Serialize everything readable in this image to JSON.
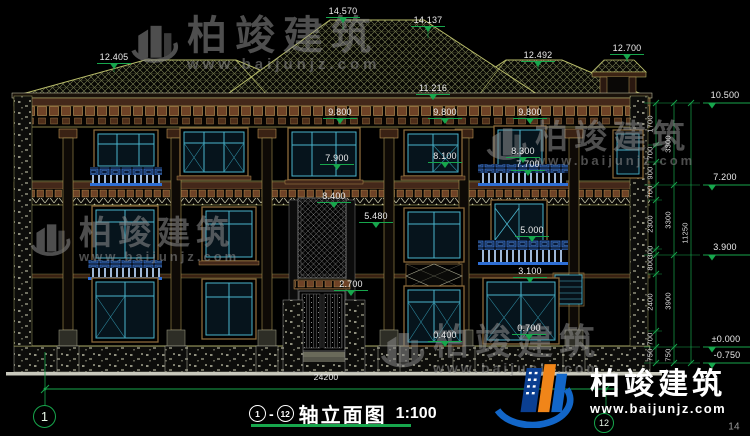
{
  "title_bar": {
    "from": "1",
    "to": "12",
    "dash": "-",
    "name": "轴立面图",
    "scale": "1:100"
  },
  "axis": {
    "left": "1",
    "right": "12"
  },
  "watermark": {
    "brand": "柏竣建筑",
    "url": "www.baijunjz.com"
  },
  "logo": {
    "brand": "柏竣建筑",
    "url": "www.baijunjz.com"
  },
  "page_number": "14",
  "colors": {
    "dim_green": "#17a64c",
    "text_white": "#ececec",
    "line_olive": "#b9bd6a",
    "cornice_brown": "#6e4226",
    "window_teal": "#4ab4cc",
    "rail_blue": "#2e6fd6",
    "logo_blue": "#1266c8",
    "logo_orange": "#f08519",
    "watermark_gray": "#8f8f8f"
  },
  "annotations": [
    {
      "t": "14.570",
      "x": 343,
      "y": 11,
      "c": "f"
    },
    {
      "t": "14.137",
      "x": 428,
      "y": 20,
      "c": "f"
    },
    {
      "t": "12.405",
      "x": 114,
      "y": 57,
      "c": "f"
    },
    {
      "t": "12.492",
      "x": 538,
      "y": 55,
      "c": "f"
    },
    {
      "t": "12.700",
      "x": 627,
      "y": 48,
      "c": "f"
    },
    {
      "t": "11.216",
      "x": 433,
      "y": 88,
      "c": "f"
    },
    {
      "t": "9.800",
      "x": 340,
      "y": 112,
      "c": "f"
    },
    {
      "t": "9.800",
      "x": 445,
      "y": 112,
      "c": "f"
    },
    {
      "t": "9.800",
      "x": 530,
      "y": 112,
      "c": "f"
    },
    {
      "t": "7.900",
      "x": 337,
      "y": 158,
      "c": "f"
    },
    {
      "t": "8.100",
      "x": 445,
      "y": 156,
      "c": "f"
    },
    {
      "t": "8.300",
      "x": 523,
      "y": 151,
      "c": "f"
    },
    {
      "t": "7.700",
      "x": 528,
      "y": 164,
      "c": "f"
    },
    {
      "t": "8.400",
      "x": 334,
      "y": 196,
      "c": "f"
    },
    {
      "t": "5.480",
      "x": 376,
      "y": 216,
      "c": "f"
    },
    {
      "t": "5.000",
      "x": 532,
      "y": 230,
      "c": "f"
    },
    {
      "t": "3.100",
      "x": 530,
      "y": 271,
      "c": "f"
    },
    {
      "t": "2.700",
      "x": 351,
      "y": 284,
      "c": "f"
    },
    {
      "t": "0.400",
      "x": 445,
      "y": 335,
      "c": "f"
    },
    {
      "t": "0.700",
      "x": 529,
      "y": 328,
      "c": "f"
    },
    {
      "t": "10.500",
      "x": 725,
      "y": 103,
      "c": "rf"
    },
    {
      "t": "7.200",
      "x": 725,
      "y": 185,
      "c": "rf"
    },
    {
      "t": "3.900",
      "x": 725,
      "y": 255,
      "c": "rf"
    },
    {
      "t": "±0.000",
      "x": 726,
      "y": 347,
      "c": "rf"
    },
    {
      "t": "-0.750",
      "x": 727,
      "y": 363,
      "c": "rf"
    },
    {
      "t": "1700",
      "x": 650,
      "y": 124,
      "c": "r"
    },
    {
      "t": "700",
      "x": 650,
      "y": 153,
      "c": "r"
    },
    {
      "t": "900",
      "x": 650,
      "y": 173,
      "c": "r"
    },
    {
      "t": "700",
      "x": 650,
      "y": 192,
      "c": "r"
    },
    {
      "t": "2300",
      "x": 650,
      "y": 224,
      "c": "r"
    },
    {
      "t": "300",
      "x": 650,
      "y": 252,
      "c": "r"
    },
    {
      "t": "800",
      "x": 650,
      "y": 264,
      "c": "r"
    },
    {
      "t": "2400",
      "x": 650,
      "y": 302,
      "c": "r"
    },
    {
      "t": "700",
      "x": 650,
      "y": 339,
      "c": "r"
    },
    {
      "t": "750",
      "x": 650,
      "y": 355,
      "c": "r"
    },
    {
      "t": "3300",
      "x": 668,
      "y": 144,
      "c": "r"
    },
    {
      "t": "3300",
      "x": 668,
      "y": 220,
      "c": "r"
    },
    {
      "t": "3900",
      "x": 668,
      "y": 301,
      "c": "r"
    },
    {
      "t": "750",
      "x": 668,
      "y": 355,
      "c": "r"
    },
    {
      "t": "11250",
      "x": 685,
      "y": 233,
      "c": "r"
    },
    {
      "t": "24200",
      "x": 326,
      "y": 377,
      "c": "p"
    },
    {
      "t": "14",
      "x": 734,
      "y": 427,
      "c": "pg"
    }
  ]
}
